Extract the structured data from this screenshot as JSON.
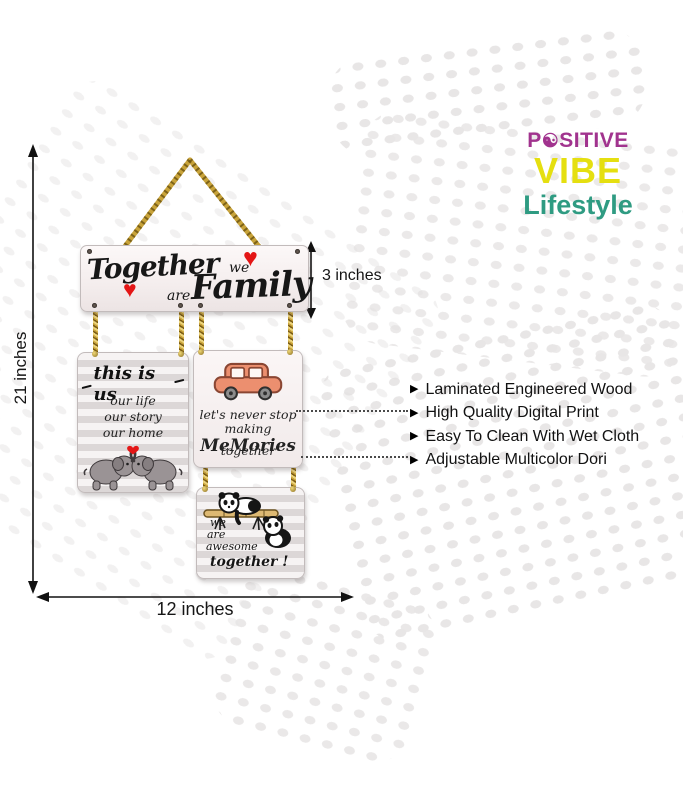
{
  "brand": {
    "word1_prefix": "P",
    "word1_symbol": "☯",
    "word1_suffix": "SITIVE",
    "word2": "VIBE",
    "word3": "Lifestyle",
    "colors": {
      "word1": "#a1338e",
      "word2": "#e5df10",
      "word3": "#2f9b82"
    }
  },
  "dimensions": {
    "height_label": "21 inches",
    "width_label": "12 inches",
    "plank_height_label": "3 inches"
  },
  "features": {
    "bullet": "▶",
    "items": [
      "Laminated Engineered Wood",
      "High Quality Digital Print",
      "Easy To Clean With Wet Cloth",
      "Adjustable Multicolor Dori"
    ]
  },
  "product": {
    "top_plank": {
      "word1": "Together",
      "word2": "we",
      "word3": "are",
      "word4": "Family",
      "heart": "♥"
    },
    "plank_this_is_us": {
      "title": "this is us",
      "line1": "our life",
      "line2": "our story",
      "line3": "our home"
    },
    "plank_memories": {
      "line1": "let's never stop",
      "line2a": "making ",
      "line2b": "MeMories",
      "line3": "together"
    },
    "plank_awesome": {
      "line1": "we",
      "line2": "are",
      "line3": "awesome",
      "line4": "together !"
    }
  },
  "colors": {
    "heart_red": "#e41616",
    "rope_gold": "#c8a33a",
    "dot_gray": "#e8e6e6"
  }
}
